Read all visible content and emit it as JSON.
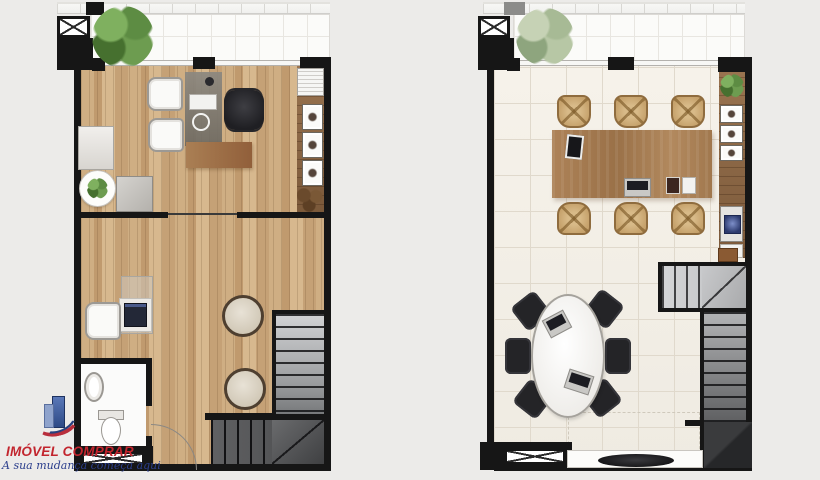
{
  "branding": {
    "title": "IMÓVEL COMPRAR",
    "tagline": "A sua mudança começa aqui"
  },
  "plans": [
    {
      "name": "level-1-floor-plan",
      "floor_finish": "wood-plank",
      "rooms": [
        "office",
        "reception",
        "bathroom",
        "stair-hall",
        "balcony"
      ]
    },
    {
      "name": "level-2-floor-plan",
      "floor_finish": "light-tile",
      "rooms": [
        "meeting-room",
        "lounge",
        "stair-hall",
        "balcony"
      ]
    }
  ],
  "palette": {
    "page-bg": "#ecebe9",
    "wall": "#161616",
    "balcony": "#fbfbf9",
    "wood-a": "#cfae83",
    "wood-b": "#c09a6e",
    "wood-c": "#d7b88e",
    "tile-line": "#e0d9cc",
    "sideboard-a": "#9a7450",
    "sideboard-b": "#7b593a",
    "table-a": "#ad8257",
    "table-b": "#9a7148",
    "chair-tan": "#c6a26c",
    "chair-tan-rim": "#8f6c3e",
    "stair-light": "#d2d3d5",
    "stair-dark": "#4a4a4c",
    "plant-dark": "#55823e",
    "plant-pale": "#9db28c",
    "logo-red": "#c2252e",
    "logo-blue": "#2b3e8c"
  }
}
